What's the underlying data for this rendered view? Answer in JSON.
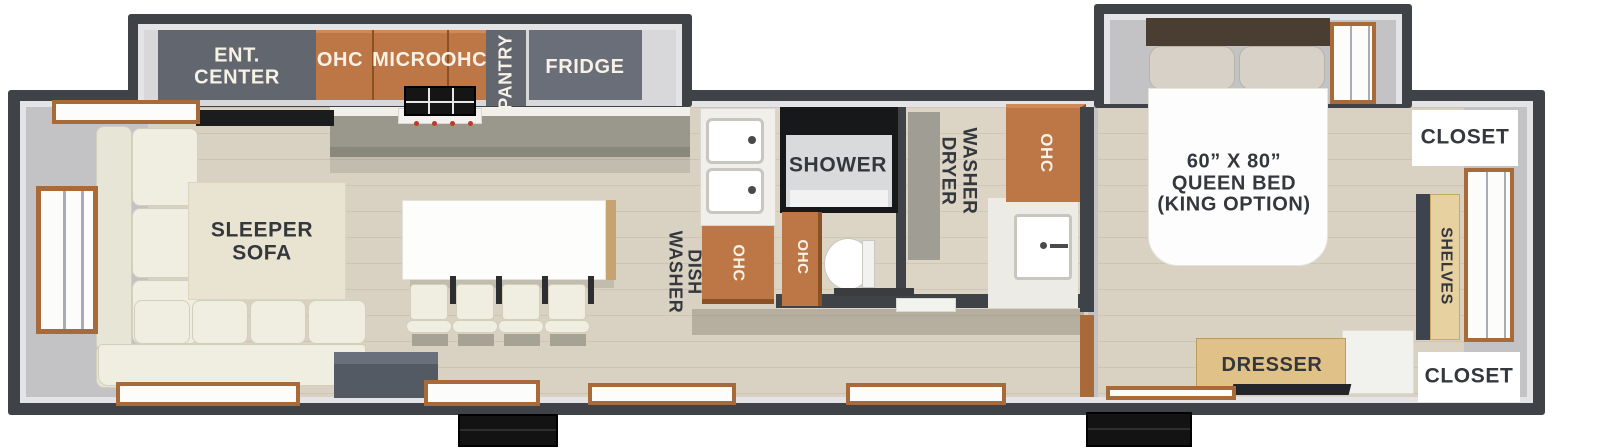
{
  "diagram_type": "rv-travel-trailer-floor-plan",
  "labels": {
    "ent_center": "ENT.\nCENTER",
    "ohc_left": "OHC",
    "micro": "MICRO",
    "ohc_right": "OHC",
    "pantry": "PANTRY",
    "fridge": "FRIDGE",
    "sleeper_sofa": "SLEEPER\nSOFA",
    "dish_washer": "DISH\nWASHER",
    "ohc_sink": "OHC",
    "shower": "SHOWER",
    "ohc_bath": "OHC",
    "washer_dryer": "WASHER\nDRYER",
    "ohc_utility": "OHC",
    "queen_bed": "60” X 80”\nQUEEN BED\n(KING OPTION)",
    "closet_top": "CLOSET",
    "shelves": "SHELVES",
    "closet_bottom": "CLOSET",
    "dresser": "DRESSER"
  },
  "colors": {
    "wall": "#3f4247",
    "wall_lining": "#e4e4e6",
    "interior_wall": "#c3c3c6",
    "floor_wood": "#d9d2c3",
    "cabinet_slate": "#62676f",
    "cabinet_orange": "#bd7747",
    "dresser_tan": "#e0c288",
    "shelves_tan": "#e7d1a0",
    "window_wood": "#a86a38",
    "sofa_cream": "#f0eee1",
    "bed_white": "#fdfdfd",
    "label_dark": "#34373c",
    "label_light": "#f8f2e6",
    "steps_black": "#131313"
  }
}
